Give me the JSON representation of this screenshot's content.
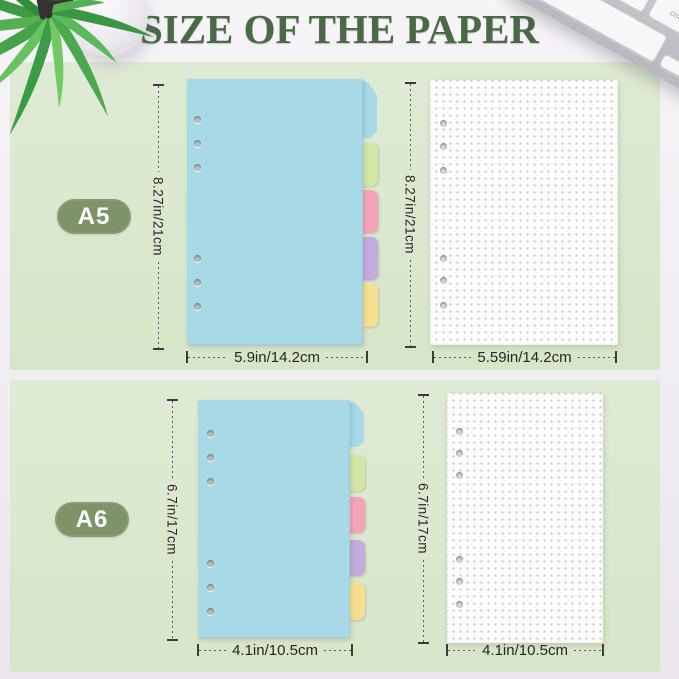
{
  "title": "SIZE OF THE PAPER",
  "colors": {
    "panel_green": "#dbe7cf",
    "badge_green": "#7e9468",
    "title_green": "#4b6946",
    "divider_blue": "#a7d9e7",
    "tab_green": "#d3e6a6",
    "tab_pink": "#f5a3b8",
    "tab_purple": "#c3abdd",
    "tab_yellow": "#f6df90",
    "paper_white": "#fdfdfb"
  },
  "keyboard": {
    "cmd_key_label": "cmd",
    "arrow_up": "▴",
    "arrow_down": "▾",
    "arrow_left": "◂",
    "arrow_right": "▸"
  },
  "rows": [
    {
      "badge": "A5",
      "divider": {
        "height_label": "8.27in/21cm",
        "width_label": "5.9in/14.2cm"
      },
      "paper": {
        "height_label": "8.27in/21cm",
        "width_label": "5.59in/14.2cm"
      }
    },
    {
      "badge": "A6",
      "divider": {
        "height_label": "6.7in/17cm",
        "width_label": "4.1in/10.5cm"
      },
      "paper": {
        "height_label": "6.7in/17cm",
        "width_label": "4.1in/10.5cm"
      }
    }
  ]
}
